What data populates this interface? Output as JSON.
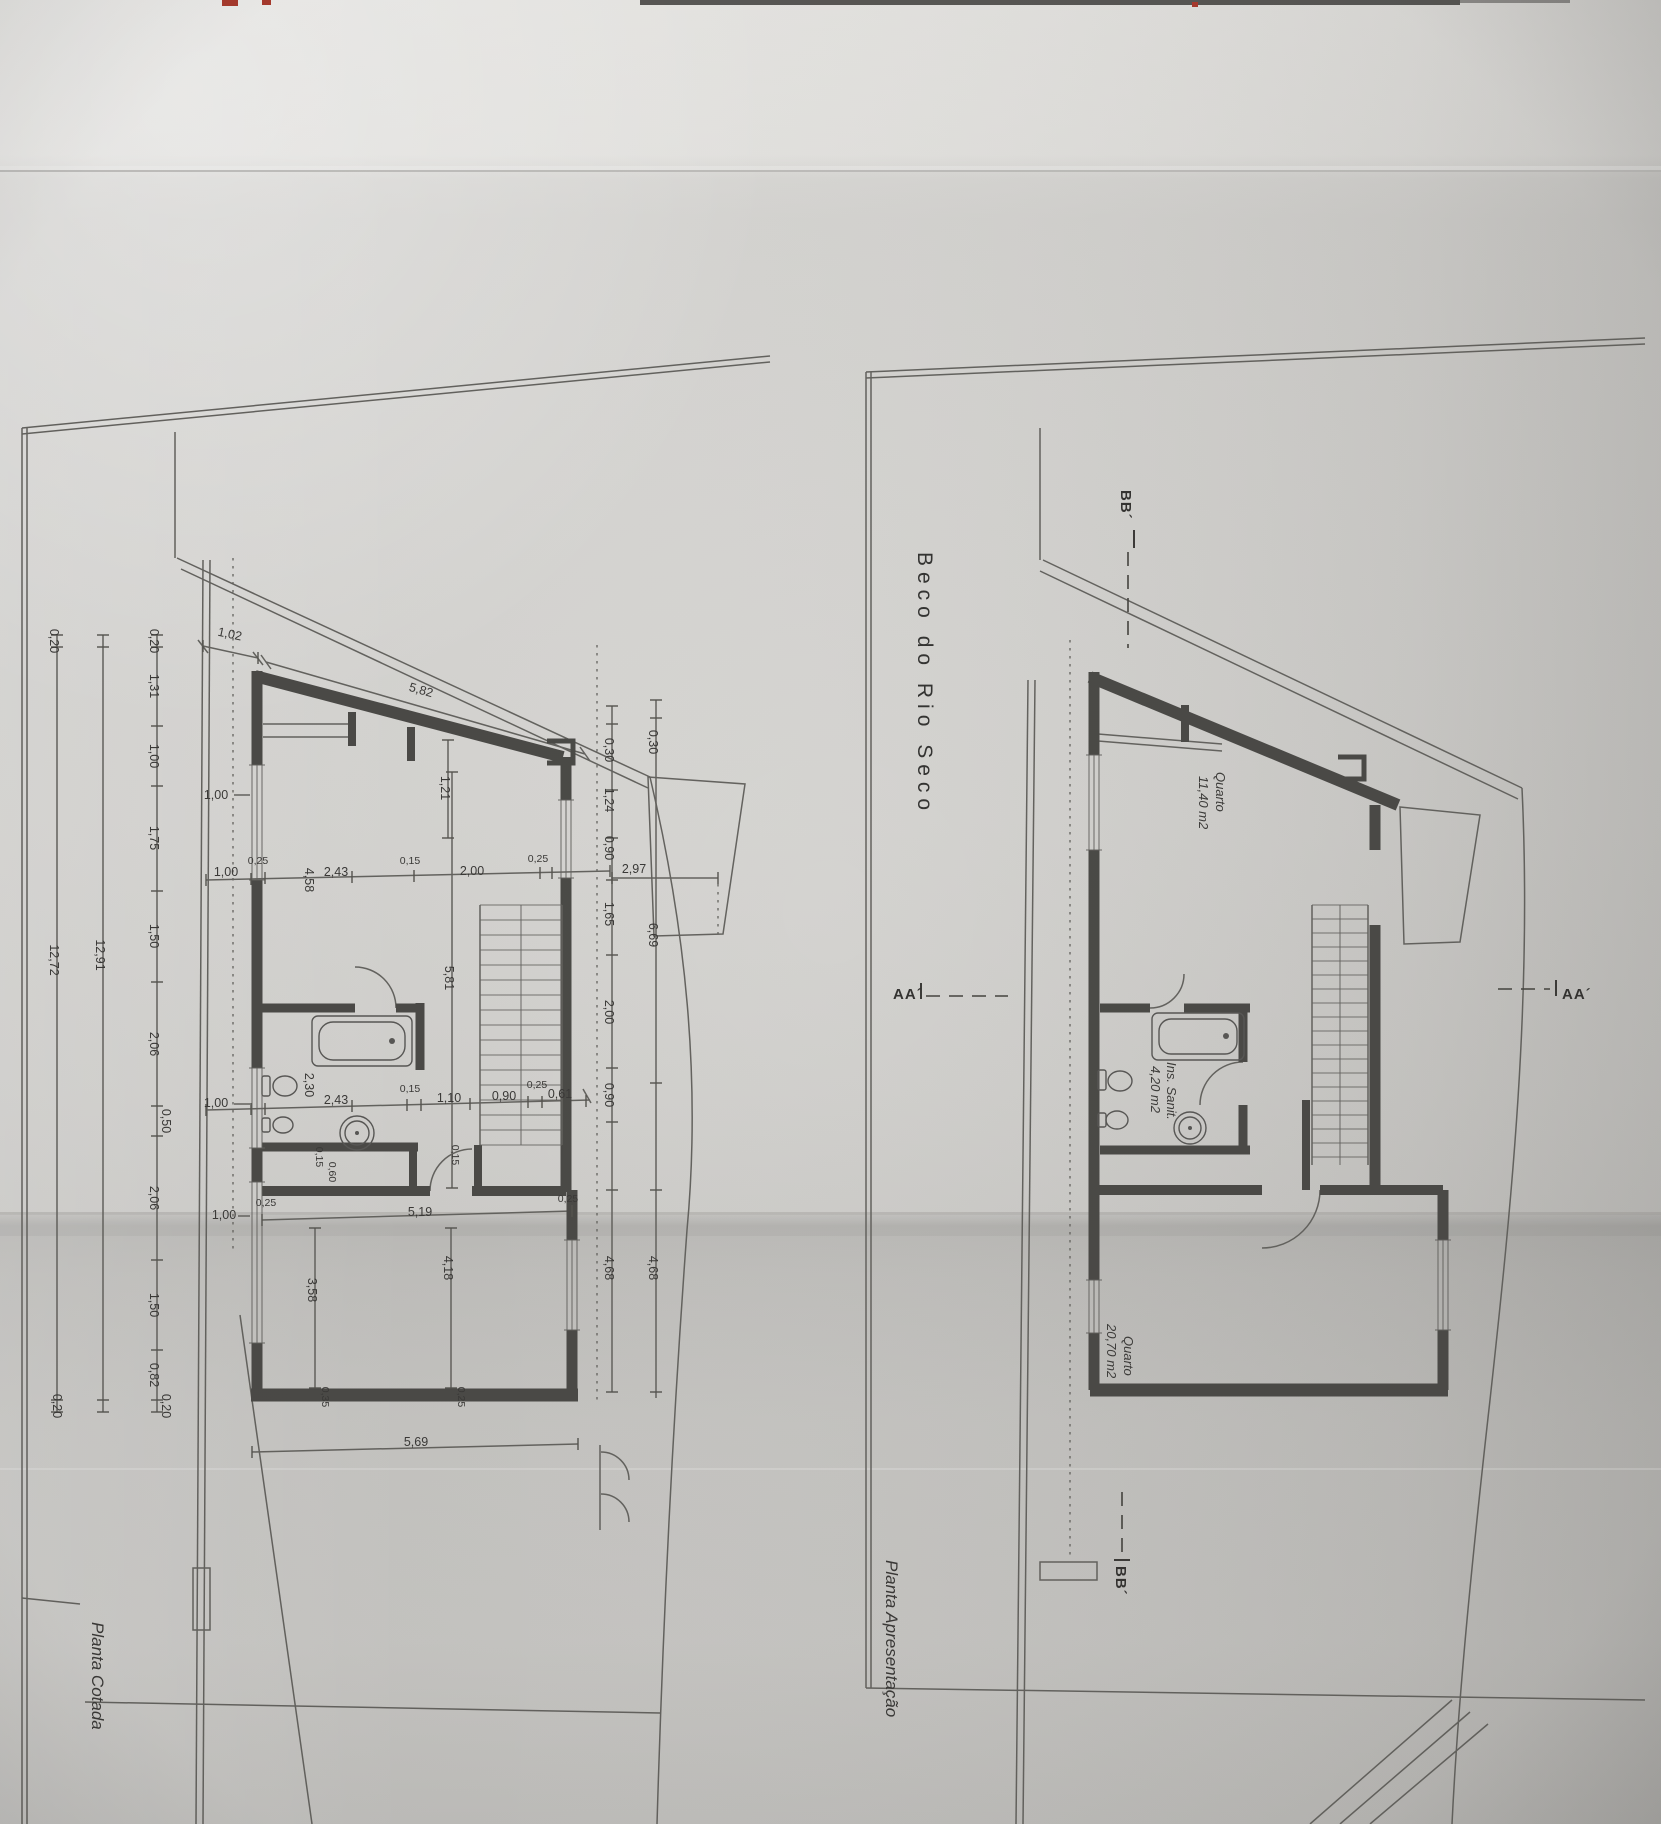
{
  "photo": {
    "description_labels": {},
    "top_strip_color": "#e8e7e4",
    "paper_color": "#d6d5d2",
    "fold_shadow_color": "#bcbbb8",
    "line_color": "#64635f",
    "wall_color": "#4b4a47",
    "text_color": "#3a3937",
    "red_mark_color": "#ab3a2c"
  },
  "left_plan": {
    "title": "Planta Cotada",
    "top_dims": [
      "1,02",
      "5,82"
    ],
    "west_outer": [
      "0,20",
      "12,72",
      "0,20"
    ],
    "west_mid": [
      "12,91"
    ],
    "west_chain": [
      "0,20",
      "1,31",
      "1,00",
      "1,75",
      "1,50",
      "2,06",
      "0,50",
      "2,06",
      "1,50",
      "0,82",
      "0,20"
    ],
    "window_dims": [
      "1,00",
      "1,00",
      "1,00"
    ],
    "row_upper": [
      "1,00",
      "0,25",
      "4,58",
      "2,43",
      "0,15",
      "2,00",
      "0,25",
      "2,97"
    ],
    "row_mid": [
      "2,43",
      "0,15",
      "1,10",
      "0,90",
      "0,25",
      "0,61"
    ],
    "interior_v": [
      "1,21",
      "5,81",
      "2,30",
      "0,15",
      "0,60",
      "0,15"
    ],
    "east_inner": [
      "0,30",
      "1,24",
      "0,90",
      "1,65",
      "2,00",
      "0,90",
      "4,68"
    ],
    "east_outer": [
      "0,30",
      "6,69",
      "4,68"
    ],
    "bottom": [
      "0,25",
      "5,19",
      "0,25",
      "3,58",
      "4,18",
      "0,35",
      "0,25",
      "5,69"
    ]
  },
  "right_plan": {
    "title": "Planta Apresentação",
    "street_name": "Beco do Rio Seco",
    "rooms": [
      {
        "name": "Quarto",
        "area": "11,40 m2"
      },
      {
        "name": "Ins. Sanit.",
        "area": "4,20 m2"
      },
      {
        "name": "Quarto",
        "area": "20,70 m2"
      }
    ],
    "section_markers": {
      "bb_top": "BB´",
      "bb_bottom": "BB´",
      "aa_left": "AA´",
      "aa_right": "AA´"
    }
  }
}
